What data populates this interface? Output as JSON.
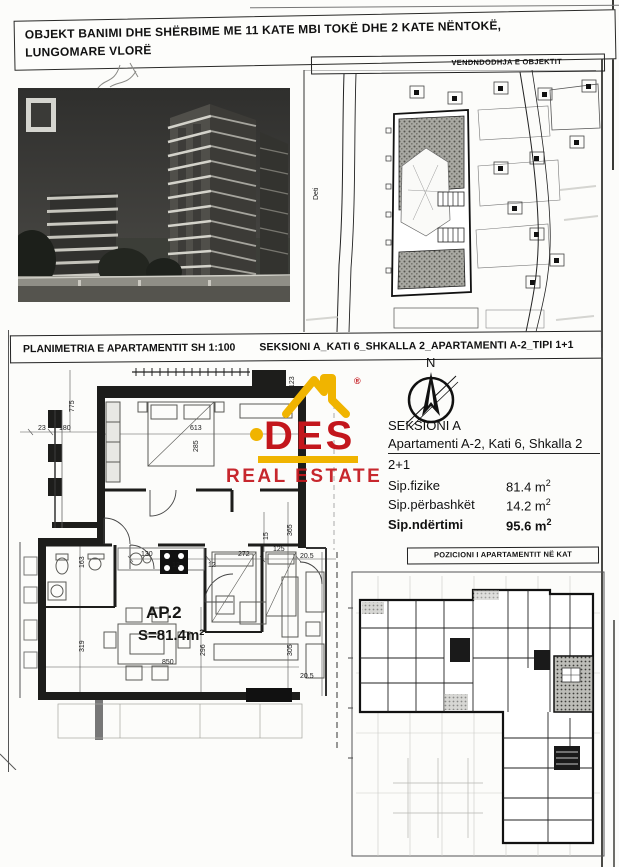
{
  "header": {
    "line1": "OBJEKT BANIMI DHE SHËRBIME ME 11 KATE MBI TOKË DHE 2 KATE NËNTOKË,",
    "line2": "LUNGOMARE VLORË"
  },
  "site_plan": {
    "title": "VENDNDODHJA E OBJEKTIT",
    "sea_label": "Deti"
  },
  "section_bar": {
    "left": "PLANIMETRIA E APARTAMENTIT SH 1:100",
    "right": "SEKSIONI A_KATI 6_SHKALLA 2_APARTAMENTI A-2_TIPI 1+1"
  },
  "logo": {
    "brand": "DES",
    "subtitle": "REAL ESTATE",
    "registered_mark": "®",
    "colors": {
      "red": "#c3161c",
      "yellow": "#f0b400"
    }
  },
  "compass": {
    "north": "N"
  },
  "apartment_info": {
    "section": "SEKSIONI A",
    "subtitle": "Apartamenti A-2, Kati 6, Shkalla 2",
    "type": "2+1",
    "metrics": [
      {
        "label": "Sip.fizike",
        "value": "81.4 m",
        "sup": "2"
      },
      {
        "label": "Sip.përbashkët",
        "value": "14.2 m",
        "sup": "2"
      },
      {
        "label": "Sip.ndërtimi",
        "value": "95.6 m",
        "sup": "2"
      }
    ]
  },
  "floor_plan": {
    "unit_label": "AP.2",
    "area_label": "S=81.4m²",
    "dims": {
      "d775": "775",
      "d23": "23",
      "d180": "180",
      "d613": "613",
      "d285": "285",
      "d123": "123",
      "d163": "163",
      "d319": "319",
      "d130": "130",
      "d12a": "12",
      "d12b": "12",
      "d272": "272",
      "d125": "125",
      "d15": "15",
      "d365": "365",
      "d296": "296",
      "d305": "305",
      "d850": "850",
      "d205a": "20.5",
      "d205b": "20.5"
    }
  },
  "position_plan": {
    "title": "POZICIONI I APARTAMENTIT NË KAT"
  }
}
